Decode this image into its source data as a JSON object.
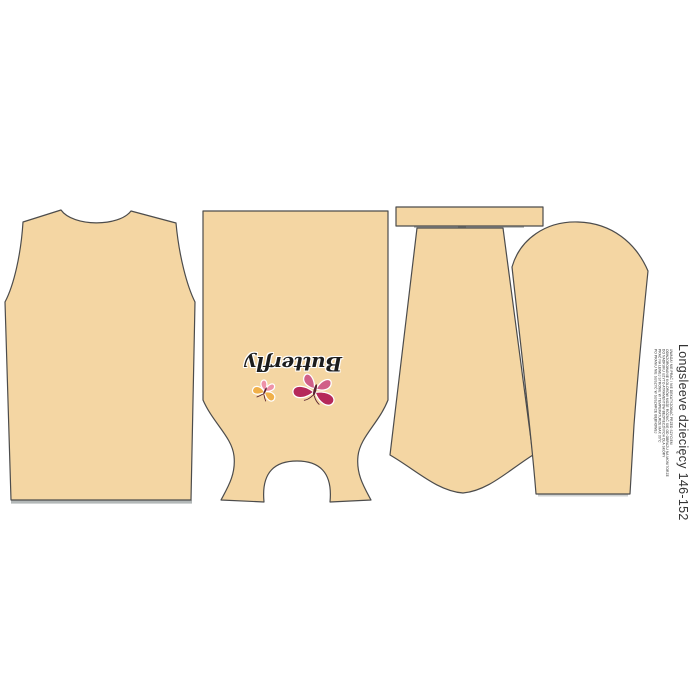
{
  "panel": {
    "title": "Longsleeve dziecięcy 146-152",
    "motif_text": "Butterfly",
    "fine_print_lines": [
      "UWAGA! NIE PRAĆ / NIE DEKATYZOWAĆ PRZED SZYCIEM",
      "ODWZOROWANIE KOLORÓW MOŻE RÓŻNIĆ SIĘ OD OBRAZU NA MONITORZE",
      "DO NADRUKU UŻYTO ATRAMENTÓW BEZPIECZNYCH DLA SKÓRY",
      "PRAĆ NA LEWEJ STRONIE W TEMPERATURZE MAX 30°C",
      "PO PRANIU NIE SUSZYĆ W SUSZARCE BĘBNOWEJ"
    ]
  },
  "colors": {
    "background": "#ffffff",
    "fabric": "#f4d6a3",
    "outline": "#4c4c4c",
    "shadow": "#a6abab",
    "shadow_light": "#cfd2d2",
    "band_shadow": "#9aa0a0",
    "title_text": "#333333",
    "fine_print_text": "#2b2b2b",
    "motif_text": "#1c1c1c",
    "butterfly_dark": "#b5295a",
    "butterfly_light": "#d05f88",
    "butterfly_yellow": "#f0b04a",
    "butterfly_pink": "#ee92a8",
    "butterfly_body": "#5a2230"
  }
}
